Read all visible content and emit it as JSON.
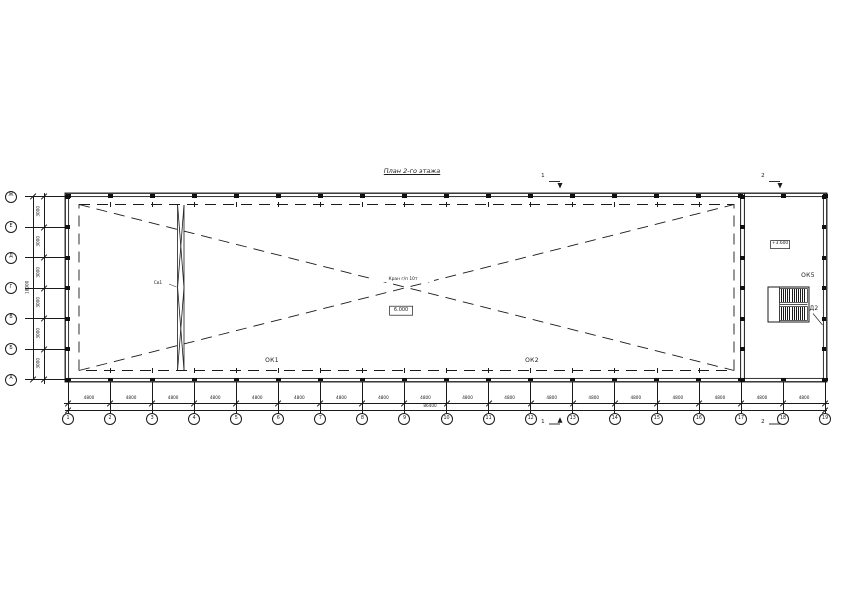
{
  "title": "План 2-го этажа",
  "axes": {
    "bottom": {
      "labels": [
        "1",
        "2",
        "3",
        "4",
        "5",
        "6",
        "7",
        "8",
        "9",
        "10",
        "11",
        "12",
        "13",
        "14",
        "15",
        "16",
        "17",
        "18",
        "19"
      ]
    },
    "left": {
      "labels": [
        "Ж",
        "Е",
        "Д",
        "Г",
        "В",
        "Б",
        "А"
      ]
    }
  },
  "dimensions": {
    "bottom_bay": "4800",
    "bottom_total": "86400",
    "left_bay": "3000",
    "left_total": "18000"
  },
  "annotations": {
    "window_label_1": "ОК1",
    "window_label_2": "ОК2",
    "window_label_5": "ОК5",
    "brace_label": "Св1",
    "door_label": "Д2",
    "center_note": "Кран г/п 10т",
    "center_elevation": "6.000",
    "right_elevation": "+3.600",
    "section_mark_1": "1",
    "section_mark_2": "2"
  },
  "colors": {
    "line": "#1a1a1a",
    "background": "#ffffff"
  }
}
